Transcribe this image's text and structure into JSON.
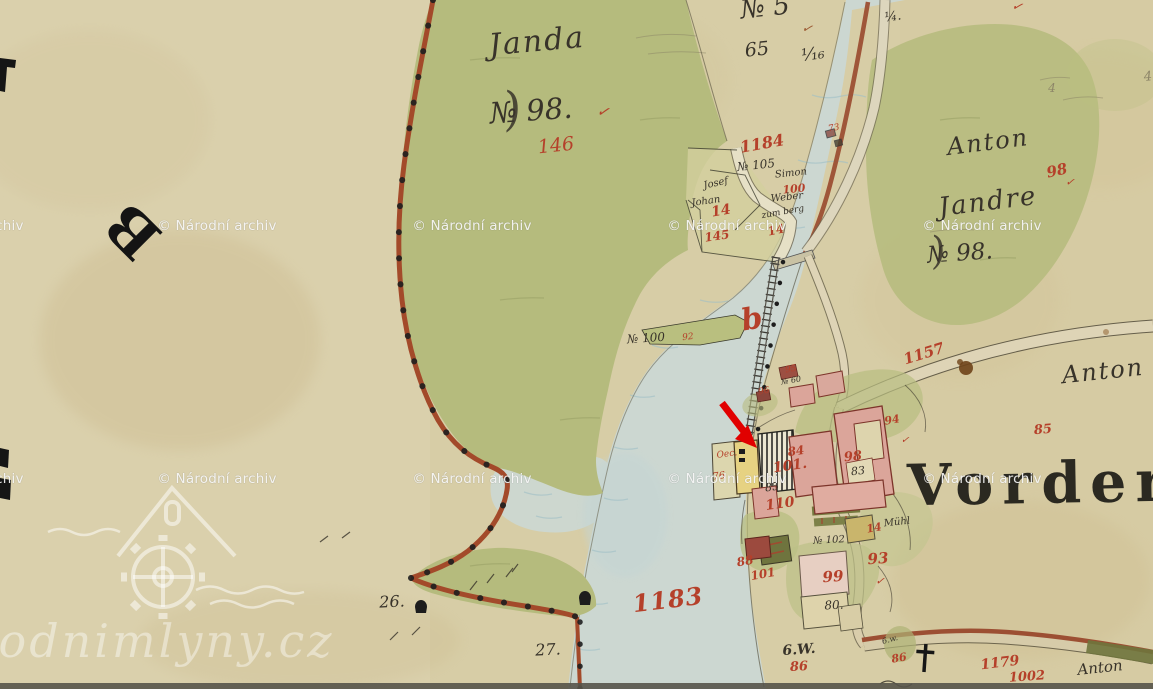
{
  "colors": {
    "paper": "#d7cda6",
    "green": "#b5bb7d",
    "stream": "#ccd7d1",
    "wave": "#9fbfc6",
    "boundary": "#a34a2a",
    "pink": "#dba59a",
    "pinkdark": "#7c342a",
    "yellow": "#e6d282",
    "road": "#ddd3b4",
    "ink": "#38332a",
    "red": "#b5402a"
  },
  "archive_watermark": {
    "text": "© Národní archiv",
    "positions": [
      {
        "x": -36,
        "y": 226
      },
      {
        "x": 217,
        "y": 226
      },
      {
        "x": 472,
        "y": 226
      },
      {
        "x": 727,
        "y": 226
      },
      {
        "x": 982,
        "y": 226
      },
      {
        "x": -36,
        "y": 479
      },
      {
        "x": 217,
        "y": 479
      },
      {
        "x": 472,
        "y": 479
      },
      {
        "x": 727,
        "y": 479
      },
      {
        "x": 982,
        "y": 479
      }
    ]
  },
  "site_watermark": {
    "text": "vodnimlyny.cz"
  },
  "labels": [
    {
      "n": "label-janda",
      "t": "Janda",
      "x": 537,
      "y": 42,
      "s": 30,
      "c": "#38332a",
      "r": -5,
      "cls": "it",
      "ls": 2
    },
    {
      "n": "label-no98-flourish",
      "t": ")",
      "x": 512,
      "y": 108,
      "s": 46,
      "c": "#38332a",
      "r": -10,
      "cls": "it",
      "o": 0.85
    },
    {
      "n": "label-no98-left",
      "t": "№ 98.",
      "x": 531,
      "y": 111,
      "s": 29,
      "c": "#38332a",
      "r": -4,
      "cls": "it"
    },
    {
      "n": "label-check-98-left",
      "t": "✓",
      "x": 603,
      "y": 112,
      "s": 15,
      "c": "#b5402a",
      "r": 10,
      "cls": "it"
    },
    {
      "n": "label-146",
      "t": "146",
      "x": 556,
      "y": 146,
      "s": 19,
      "c": "#b5402a",
      "r": -6,
      "cls": "it"
    },
    {
      "n": "label-no5-top",
      "t": "№ 5",
      "x": 765,
      "y": 8,
      "s": 26,
      "c": "#38332a",
      "r": -6,
      "cls": "it"
    },
    {
      "n": "label-quarter",
      "t": "¼.",
      "x": 893,
      "y": 17,
      "s": 13,
      "c": "#38332a",
      "r": -8,
      "cls": "it"
    },
    {
      "n": "label-check-top",
      "t": "✓",
      "x": 807,
      "y": 29,
      "s": 13,
      "c": "#9c5a33",
      "r": 14,
      "cls": "it"
    },
    {
      "n": "label-65",
      "t": "65",
      "x": 757,
      "y": 50,
      "s": 19,
      "c": "#38332a",
      "r": -6,
      "cls": "it"
    },
    {
      "n": "label-frac16",
      "t": "¹⁄₁₆",
      "x": 813,
      "y": 55,
      "s": 17,
      "c": "#38332a",
      "r": -8,
      "cls": "it"
    },
    {
      "n": "label-1184",
      "t": "1184",
      "x": 762,
      "y": 144,
      "s": 16,
      "c": "#b5402a",
      "r": -10,
      "cls": "it b"
    },
    {
      "n": "label-no105",
      "t": "№ 105",
      "x": 756,
      "y": 165,
      "s": 12,
      "c": "#38332a",
      "r": -6,
      "cls": "it"
    },
    {
      "n": "label-simon",
      "t": "Simon",
      "x": 791,
      "y": 174,
      "s": 10,
      "c": "#38332a",
      "r": -6,
      "cls": "it"
    },
    {
      "n": "label-100",
      "t": "100",
      "x": 794,
      "y": 189,
      "s": 11,
      "c": "#b5402a",
      "r": -6,
      "cls": "it b"
    },
    {
      "n": "label-weber",
      "t": "Weber",
      "x": 787,
      "y": 198,
      "s": 10,
      "c": "#38332a",
      "r": -6,
      "cls": "it"
    },
    {
      "n": "label-zumberg",
      "t": "zum berg",
      "x": 783,
      "y": 213,
      "s": 9,
      "c": "#38332a",
      "r": -10,
      "cls": "it"
    },
    {
      "n": "label-14-right",
      "t": "14",
      "x": 776,
      "y": 230,
      "s": 12,
      "c": "#b5402a",
      "r": -12,
      "cls": "it b"
    },
    {
      "n": "label-josef",
      "t": "Josef",
      "x": 716,
      "y": 184,
      "s": 10,
      "c": "#38332a",
      "r": -12,
      "cls": "it"
    },
    {
      "n": "label-johan",
      "t": "Johan",
      "x": 706,
      "y": 202,
      "s": 10,
      "c": "#38332a",
      "r": -8,
      "cls": "it"
    },
    {
      "n": "label-14-left",
      "t": "14",
      "x": 721,
      "y": 211,
      "s": 14,
      "c": "#b5402a",
      "r": -10,
      "cls": "it b"
    },
    {
      "n": "label-145",
      "t": "145",
      "x": 717,
      "y": 236,
      "s": 12,
      "c": "#b5402a",
      "r": -8,
      "cls": "it b"
    },
    {
      "n": "label-73",
      "t": "73",
      "x": 834,
      "y": 129,
      "s": 9,
      "c": "#b5402a",
      "r": -10,
      "cls": "it"
    },
    {
      "n": "label-anton-topright",
      "t": "Anton",
      "x": 988,
      "y": 142,
      "s": 24,
      "c": "#38332a",
      "r": -7,
      "cls": "it",
      "ls": 2
    },
    {
      "n": "label-98-red",
      "t": "98",
      "x": 1057,
      "y": 171,
      "s": 15,
      "c": "#b5402a",
      "r": -12,
      "cls": "it b"
    },
    {
      "n": "label-check-98-red",
      "t": "✓",
      "x": 1070,
      "y": 182,
      "s": 11,
      "c": "#b5402a",
      "r": 5,
      "cls": "it"
    },
    {
      "n": "label-jandre",
      "t": "Jandre",
      "x": 988,
      "y": 202,
      "s": 26,
      "c": "#38332a",
      "r": -7,
      "cls": "it",
      "ls": 2
    },
    {
      "n": "label-no98-flourish2",
      "t": ")",
      "x": 938,
      "y": 250,
      "s": 38,
      "c": "#38332a",
      "r": -10,
      "cls": "it",
      "o": 0.85
    },
    {
      "n": "label-no98-right",
      "t": "№ 98.",
      "x": 960,
      "y": 254,
      "s": 23,
      "c": "#38332a",
      "r": -4,
      "cls": "it"
    },
    {
      "n": "label-pencil-4a",
      "t": "4",
      "x": 1052,
      "y": 88,
      "s": 12,
      "c": "#8d8568",
      "r": 0,
      "cls": "it"
    },
    {
      "n": "label-pencil-4b",
      "t": "4",
      "x": 1148,
      "y": 77,
      "s": 13,
      "c": "#8d8568",
      "r": -5,
      "cls": "it"
    },
    {
      "n": "label-check-corner",
      "t": "✓",
      "x": 1017,
      "y": 7,
      "s": 13,
      "c": "#b5402a",
      "r": 15,
      "cls": "it"
    },
    {
      "n": "label-no100",
      "t": "№ 100",
      "x": 646,
      "y": 338,
      "s": 12,
      "c": "#38332a",
      "r": -4,
      "cls": "it"
    },
    {
      "n": "label-92",
      "t": "92",
      "x": 688,
      "y": 338,
      "s": 9,
      "c": "#b5402a",
      "r": -6,
      "cls": "it"
    },
    {
      "n": "label-b-flourish",
      "t": "b",
      "x": 752,
      "y": 320,
      "s": 30,
      "c": "#b5402a",
      "r": -10,
      "cls": "it b"
    },
    {
      "n": "label-1157",
      "t": "1157",
      "x": 924,
      "y": 354,
      "s": 15,
      "c": "#b5402a",
      "r": -17,
      "cls": "it b"
    },
    {
      "n": "label-anton-right",
      "t": "Anton",
      "x": 1103,
      "y": 371,
      "s": 24,
      "c": "#38332a",
      "r": -6,
      "cls": "it",
      "ls": 2
    },
    {
      "n": "label-85-red",
      "t": "85",
      "x": 1043,
      "y": 430,
      "s": 13,
      "c": "#b5402a",
      "r": -5,
      "cls": "it b"
    },
    {
      "n": "label-95",
      "t": "95",
      "x": 791,
      "y": 370,
      "s": 9,
      "c": "#b5402a",
      "r": -10,
      "cls": "it"
    },
    {
      "n": "label-no60",
      "t": "№ 60",
      "x": 791,
      "y": 381,
      "s": 8,
      "c": "#38332a",
      "r": -10,
      "cls": "it"
    },
    {
      "n": "label-96",
      "t": "96",
      "x": 764,
      "y": 392,
      "s": 9,
      "c": "#b5402a",
      "r": -10,
      "cls": "it"
    },
    {
      "n": "label-oec",
      "t": "Oec.",
      "x": 727,
      "y": 455,
      "s": 9,
      "c": "#b5402a",
      "r": -8,
      "cls": "it"
    },
    {
      "n": "label-76",
      "t": "76",
      "x": 719,
      "y": 477,
      "s": 10,
      "c": "#b5402a",
      "r": -8,
      "cls": "it"
    },
    {
      "n": "label-84",
      "t": "84",
      "x": 796,
      "y": 451,
      "s": 12,
      "c": "#b5402a",
      "r": -8,
      "cls": "it b"
    },
    {
      "n": "label-101-upper",
      "t": "101.",
      "x": 790,
      "y": 466,
      "s": 14,
      "c": "#b5402a",
      "r": -8,
      "cls": "it b"
    },
    {
      "n": "label-85-ink",
      "t": "85",
      "x": 772,
      "y": 487,
      "s": 11,
      "c": "#38332a",
      "r": -8,
      "cls": "it"
    },
    {
      "n": "label-110",
      "t": "110",
      "x": 780,
      "y": 504,
      "s": 14,
      "c": "#b5402a",
      "r": -8,
      "cls": "it b"
    },
    {
      "n": "label-98-building",
      "t": "98",
      "x": 853,
      "y": 457,
      "s": 13,
      "c": "#b5402a",
      "r": -6,
      "cls": "it b"
    },
    {
      "n": "label-83",
      "t": "83",
      "x": 858,
      "y": 471,
      "s": 11,
      "c": "#38332a",
      "r": -6,
      "cls": "it"
    },
    {
      "n": "label-94",
      "t": "94",
      "x": 892,
      "y": 420,
      "s": 11,
      "c": "#b5402a",
      "r": -10,
      "cls": "it b"
    },
    {
      "n": "label-check-94",
      "t": "✓",
      "x": 905,
      "y": 441,
      "s": 10,
      "c": "#b5402a",
      "r": 5,
      "cls": "it"
    },
    {
      "n": "label-88",
      "t": "88",
      "x": 745,
      "y": 561,
      "s": 12,
      "c": "#b5402a",
      "r": -10,
      "cls": "it b"
    },
    {
      "n": "label-101-lower",
      "t": "101",
      "x": 763,
      "y": 574,
      "s": 12,
      "c": "#b5402a",
      "r": -10,
      "cls": "it b"
    },
    {
      "n": "label-99",
      "t": "99",
      "x": 833,
      "y": 577,
      "s": 15,
      "c": "#b5402a",
      "r": -4,
      "cls": "it b"
    },
    {
      "n": "label-80",
      "t": "80.",
      "x": 834,
      "y": 605,
      "s": 12,
      "c": "#38332a",
      "r": -3,
      "cls": "it"
    },
    {
      "n": "label-93",
      "t": "93",
      "x": 878,
      "y": 559,
      "s": 15,
      "c": "#b5402a",
      "r": -4,
      "cls": "it b"
    },
    {
      "n": "label-check-93",
      "t": "✓",
      "x": 880,
      "y": 581,
      "s": 11,
      "c": "#b5402a",
      "r": 5,
      "cls": "it"
    },
    {
      "n": "label-no102",
      "t": "№ 102",
      "x": 829,
      "y": 541,
      "s": 10,
      "c": "#38332a",
      "r": -3,
      "cls": "it"
    },
    {
      "n": "label-14-mid",
      "t": "14",
      "x": 874,
      "y": 528,
      "s": 11,
      "c": "#b5402a",
      "r": -10,
      "cls": "it b"
    },
    {
      "n": "label-muhl",
      "t": "Mühl",
      "x": 897,
      "y": 523,
      "s": 10,
      "c": "#38332a",
      "r": -6,
      "cls": "it"
    },
    {
      "n": "label-6w",
      "t": "6.W.",
      "x": 799,
      "y": 650,
      "s": 14,
      "c": "#38332a",
      "r": -4,
      "cls": "it b"
    },
    {
      "n": "label-86-left",
      "t": "86",
      "x": 799,
      "y": 667,
      "s": 13,
      "c": "#b5402a",
      "r": -3,
      "cls": "it b"
    },
    {
      "n": "label-6w-small",
      "t": "6.w.",
      "x": 890,
      "y": 640,
      "s": 8,
      "c": "#38332a",
      "r": -15,
      "cls": "it"
    },
    {
      "n": "label-86-right",
      "t": "86",
      "x": 899,
      "y": 658,
      "s": 11,
      "c": "#b5402a",
      "r": -10,
      "cls": "it b"
    },
    {
      "n": "label-1179",
      "t": "1179",
      "x": 1000,
      "y": 663,
      "s": 14,
      "c": "#b5402a",
      "r": -7,
      "cls": "it b"
    },
    {
      "n": "label-1002",
      "t": "1002",
      "x": 1027,
      "y": 677,
      "s": 13,
      "c": "#b5402a",
      "r": -4,
      "cls": "it b"
    },
    {
      "n": "label-anton-bottom",
      "t": "Anton",
      "x": 1100,
      "y": 668,
      "s": 15,
      "c": "#38332a",
      "r": -6,
      "cls": "it"
    },
    {
      "n": "label-1183",
      "t": "1183",
      "x": 668,
      "y": 600,
      "s": 24,
      "c": "#b5402a",
      "r": -7,
      "cls": "it b",
      "ls": 1
    },
    {
      "n": "label-26",
      "t": "26.",
      "x": 392,
      "y": 602,
      "s": 16,
      "c": "#38332a",
      "r": -3,
      "cls": "it"
    },
    {
      "n": "label-27",
      "t": "27.",
      "x": 548,
      "y": 650,
      "s": 16,
      "c": "#38332a",
      "r": -3,
      "cls": "it"
    },
    {
      "n": "label-vorder",
      "t": "Vorderh",
      "x": 1066,
      "y": 483,
      "s": 57,
      "c": "#1d1c16",
      "r": -1,
      "cls": "srf b",
      "ls": 9,
      "o": 0.92
    },
    {
      "n": "label-big-letter-b",
      "t": "B",
      "x": 133,
      "y": 231,
      "s": 58,
      "c": "#141414",
      "r": -135,
      "cls": "srf b"
    }
  ]
}
